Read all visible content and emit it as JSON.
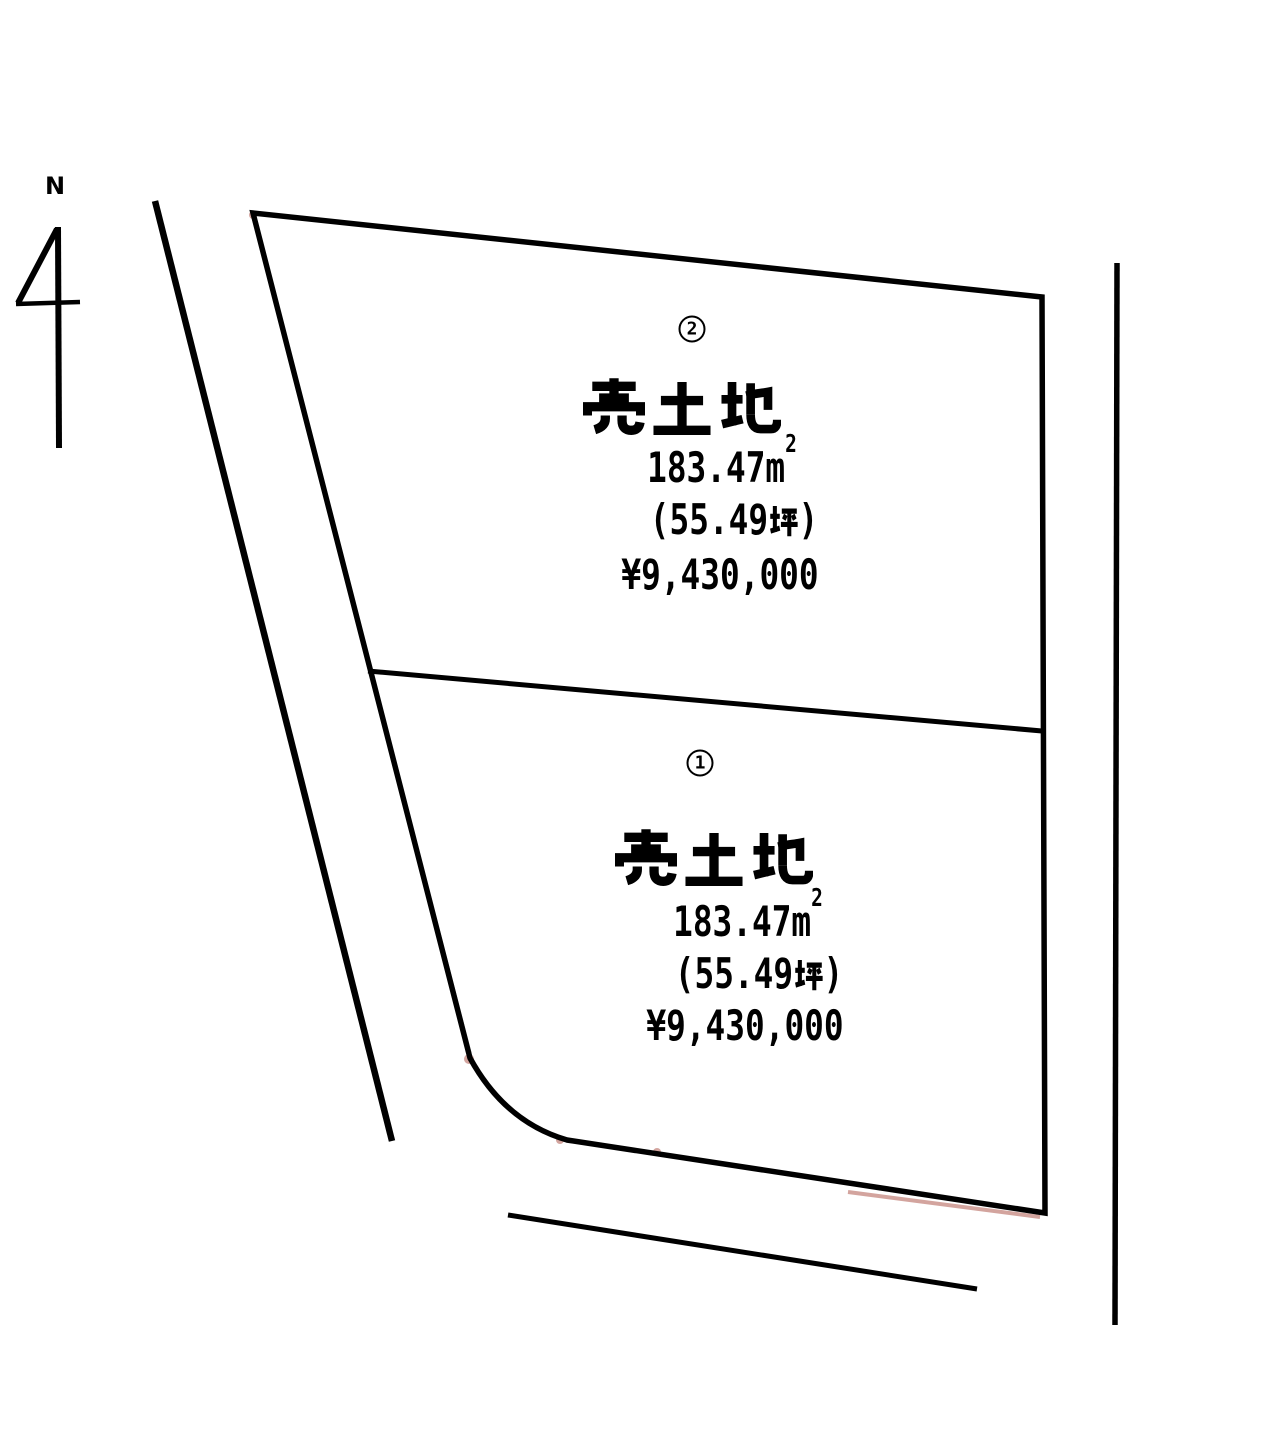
{
  "diagram": {
    "background_color": "#ffffff",
    "line_color": "#000000",
    "artifact_red": "#a84c3f"
  },
  "compass": {
    "label": "N"
  },
  "plots": [
    {
      "number": "2",
      "number_circled": "②",
      "title": "売土地",
      "area_value": "183.47",
      "area_unit_m": "m",
      "area_unit_exponent": "2",
      "area_text": "183.47㎡",
      "tsubo_prefix": "(55.49",
      "tsubo_unit": "坪",
      "tsubo_suffix": ")",
      "tsubo_text": "(55.49坪)",
      "price": "¥9,430,000"
    },
    {
      "number": "1",
      "number_circled": "①",
      "title": "売土地",
      "area_value": "183.47",
      "area_unit_m": "m",
      "area_unit_exponent": "2",
      "area_text": "183.47㎡",
      "tsubo_prefix": "(55.49",
      "tsubo_unit": "坪",
      "tsubo_suffix": ")",
      "tsubo_text": "(55.49坪)",
      "price": "¥9,430,000"
    }
  ]
}
